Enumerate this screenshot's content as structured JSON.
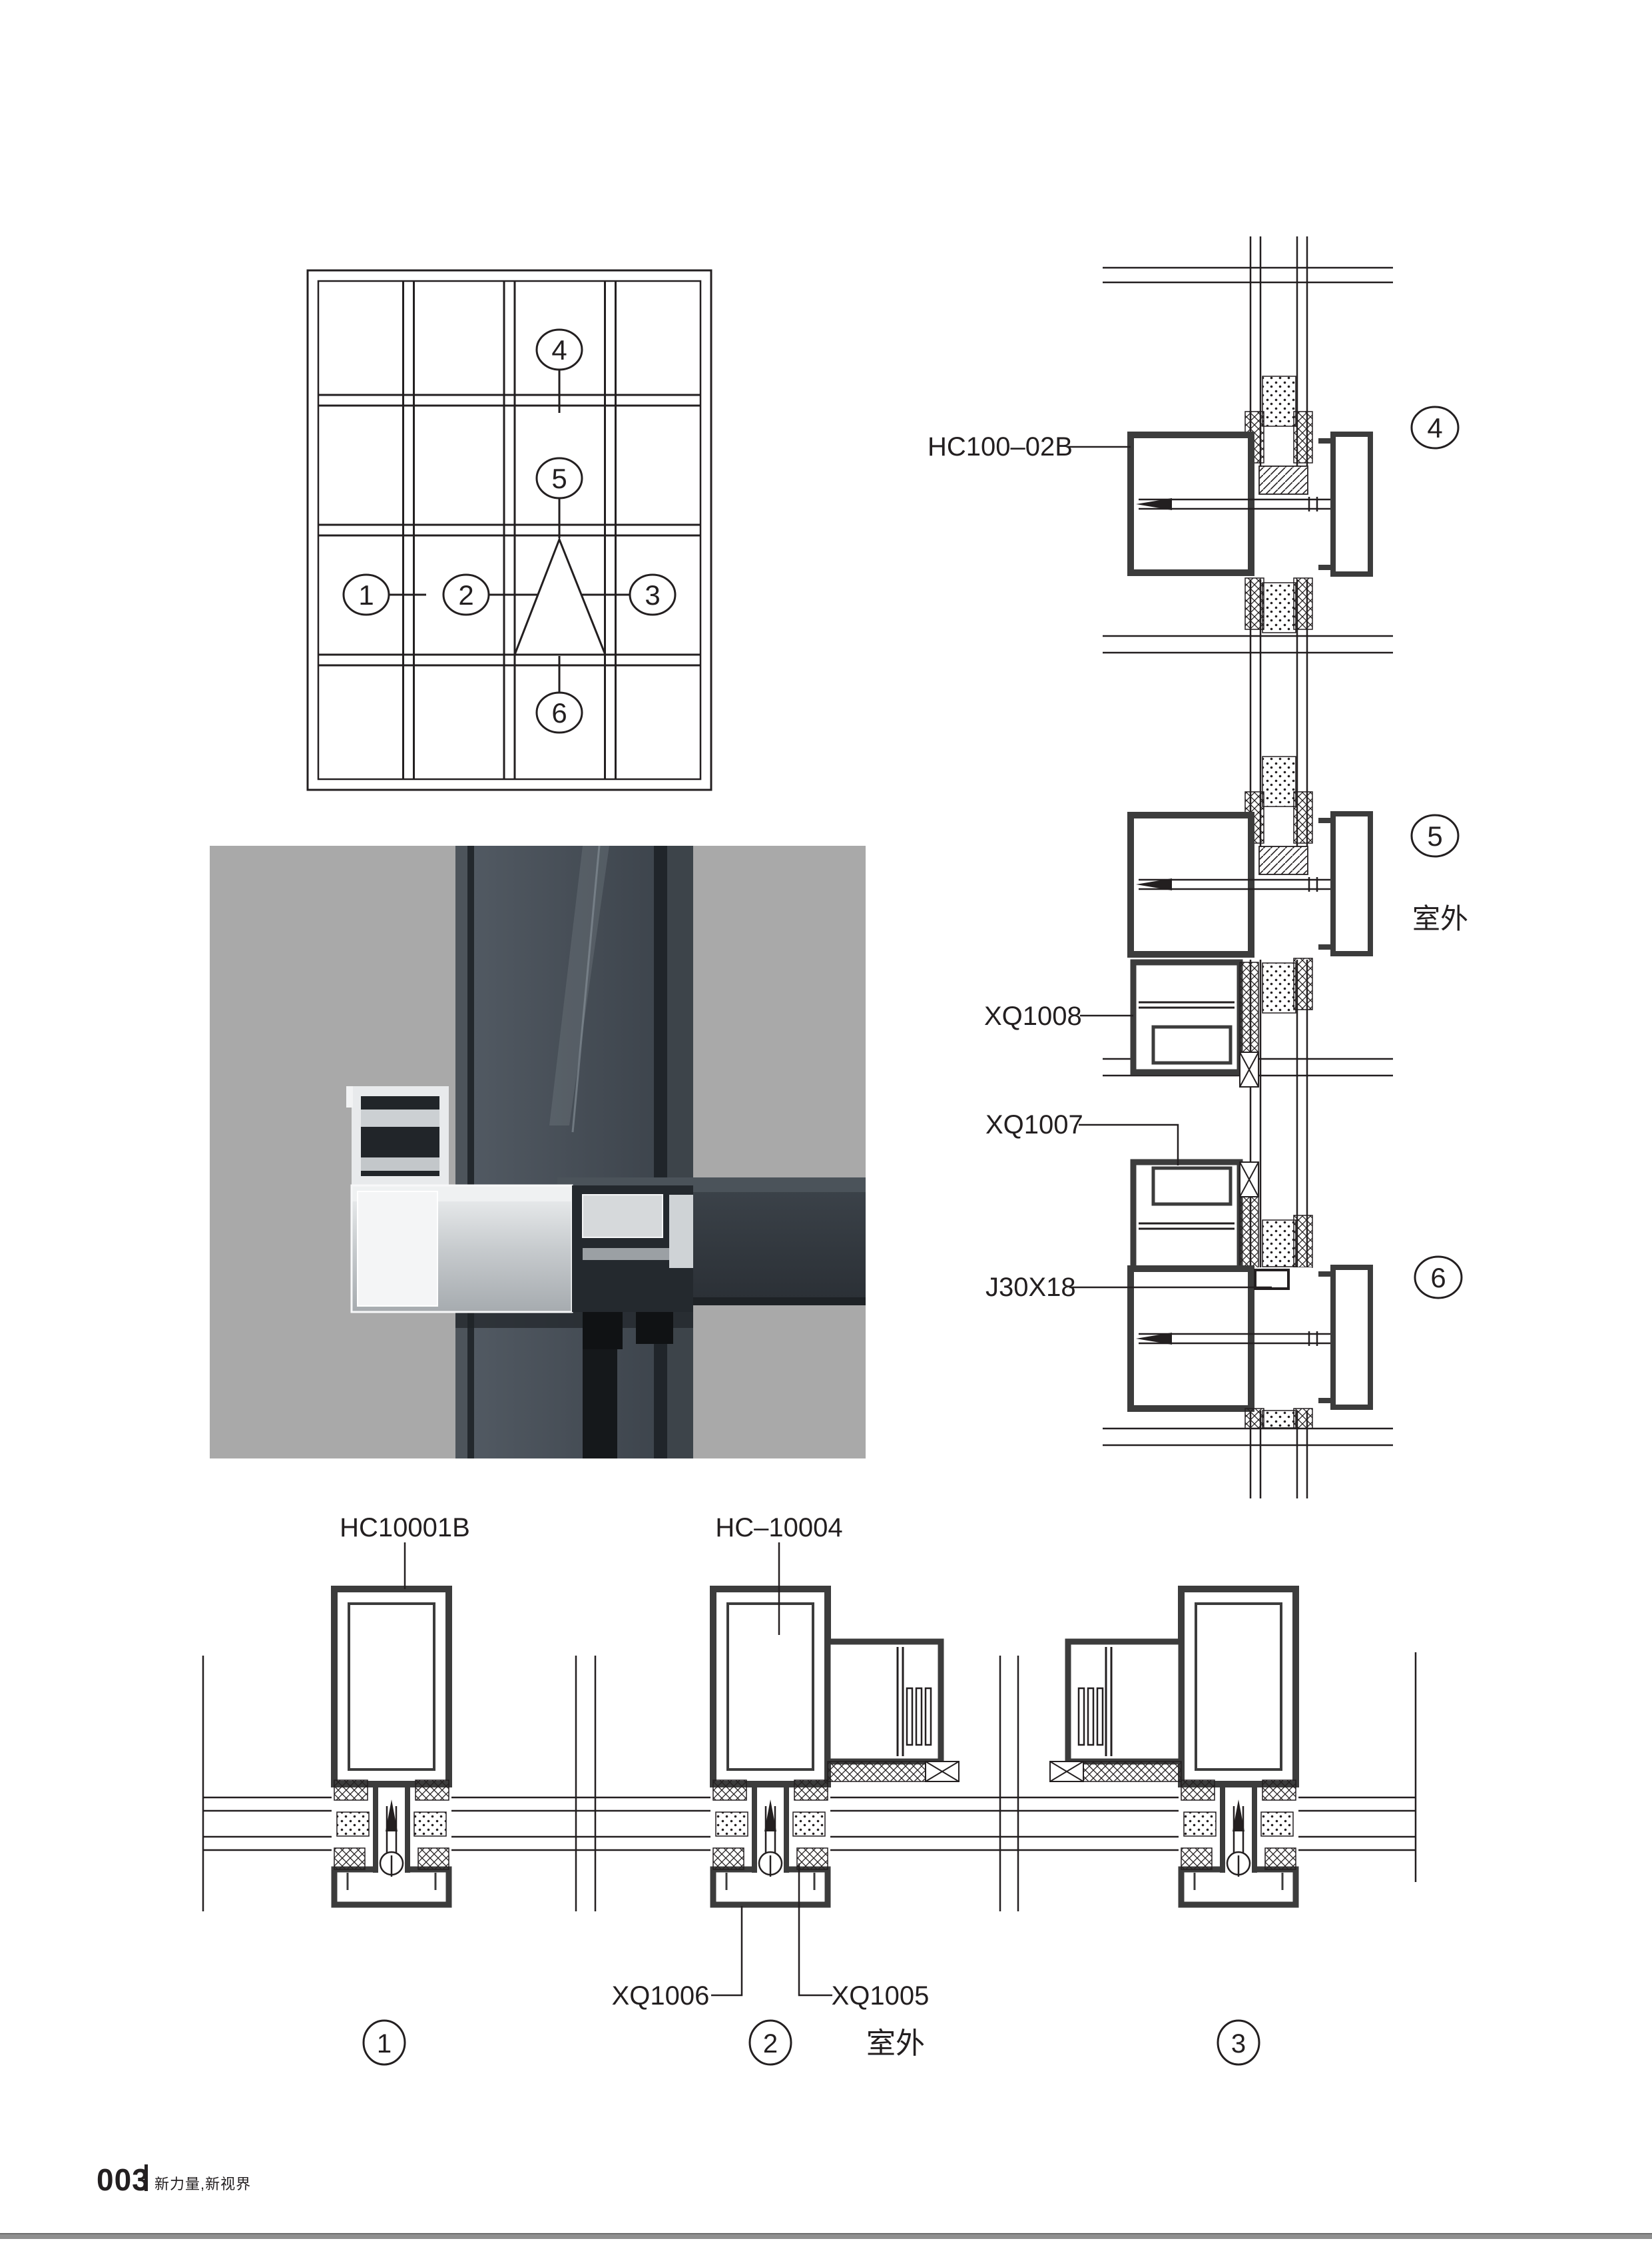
{
  "page": {
    "number": "003",
    "tagline": "新力量,新视界"
  },
  "elevation": {
    "callouts": {
      "c1": "1",
      "c2": "2",
      "c3": "3",
      "c4": "4",
      "c5": "5",
      "c6": "6"
    }
  },
  "vsec": {
    "label_transom": "HC100–02B",
    "label_vent_lower": "XQ1008",
    "label_vent_upper": "XQ1007",
    "label_bracket": "J30X18",
    "callouts": {
      "c4": "4",
      "c5": "5",
      "c6": "6"
    },
    "outdoor": "室外"
  },
  "hsec": {
    "label_mullion": "HC10001B",
    "label_mullion_vent": "HC–10004",
    "label_cap": "XQ1006",
    "label_subframe": "XQ1005",
    "callouts": {
      "c1": "1",
      "c2": "2",
      "c3": "3"
    },
    "outdoor": "室外"
  },
  "colors": {
    "line": "#231f20",
    "profile_wall": "#3c3c3c",
    "photo_background": "#a9a9a9",
    "footer_bar": "#8f8f8f"
  }
}
